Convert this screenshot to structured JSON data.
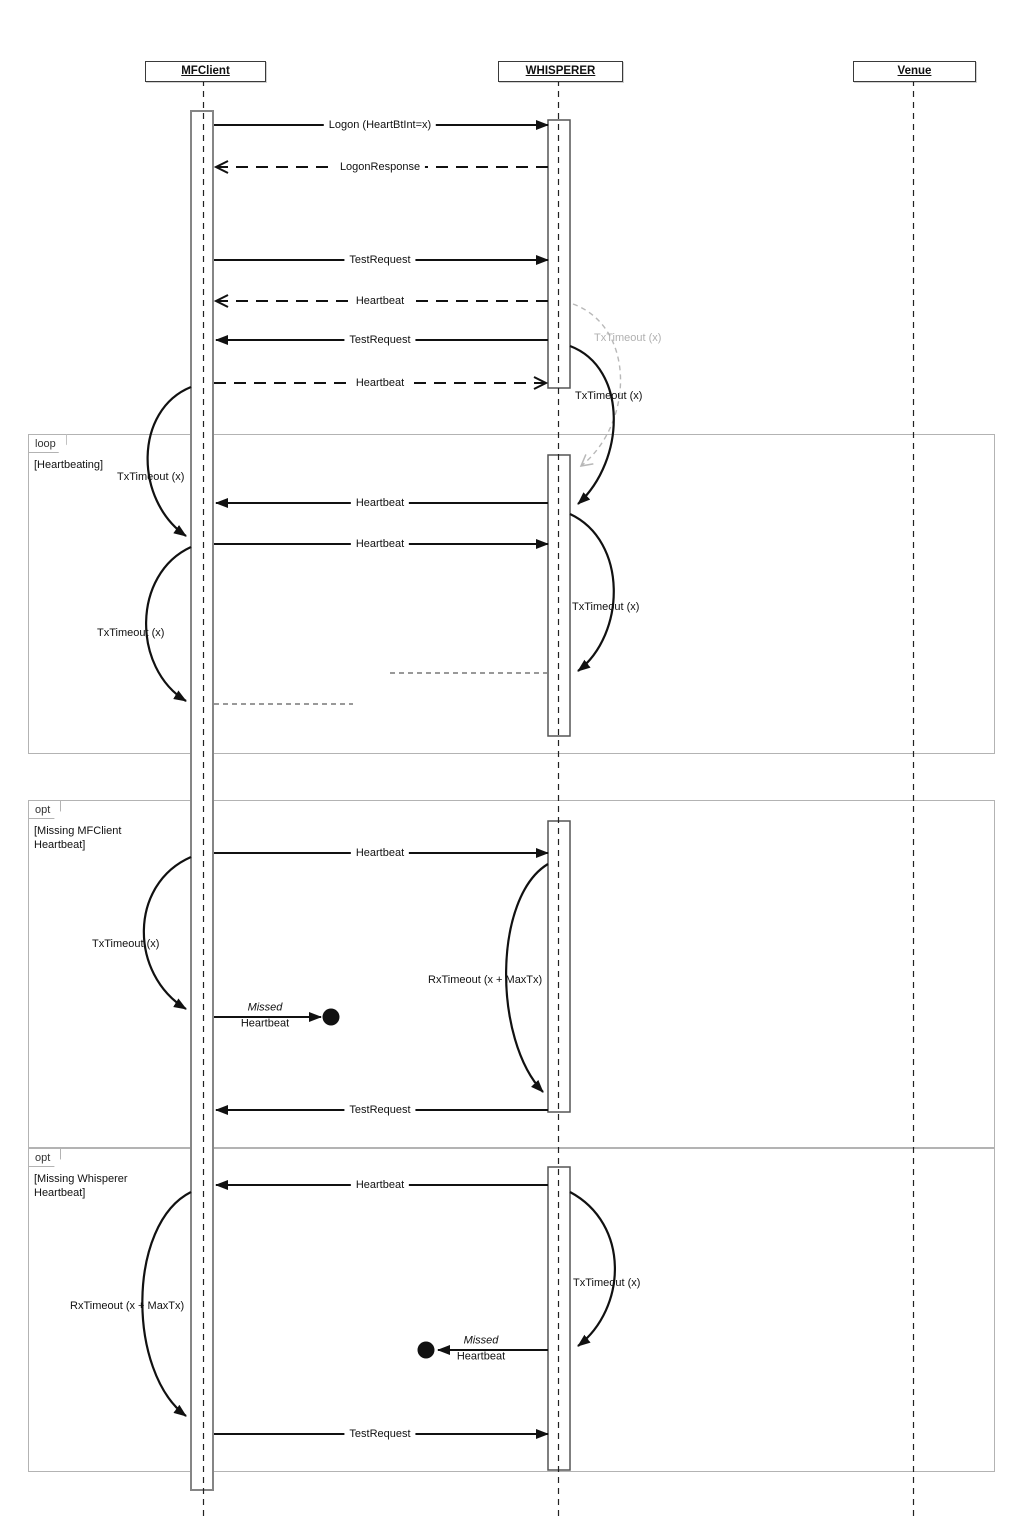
{
  "diagram": {
    "type": "uml-sequence",
    "actors": {
      "mfclient": "MFClient",
      "whisperer": "WHISPERER",
      "venue": "Venue"
    },
    "fragments": {
      "loop": {
        "operator": "loop",
        "guard": "[Heartbeating]"
      },
      "opt_missing_mfclient": {
        "operator": "opt",
        "guard_line1": "[Missing MFClient",
        "guard_line2": "Heartbeat]"
      },
      "opt_missing_whisperer": {
        "operator": "opt",
        "guard_line1": "[Missing Whisperer",
        "guard_line2": "Heartbeat]"
      }
    },
    "messages": {
      "logon": "Logon (HeartBtInt=x)",
      "logon_response": "LogonResponse",
      "test_request": "TestRequest",
      "heartbeat": "Heartbeat"
    },
    "timers": {
      "tx_timeout": "TxTimeout (x)",
      "rx_timeout": "RxTimeout (x + MaxTx)"
    },
    "lost_message": {
      "line1": "Missed",
      "line2": "Heartbeat"
    },
    "colors": {
      "line": "#111111",
      "frame_border": "#b3b3b3",
      "ghost": "#b8b8b8",
      "activation_border": "#858585"
    }
  }
}
